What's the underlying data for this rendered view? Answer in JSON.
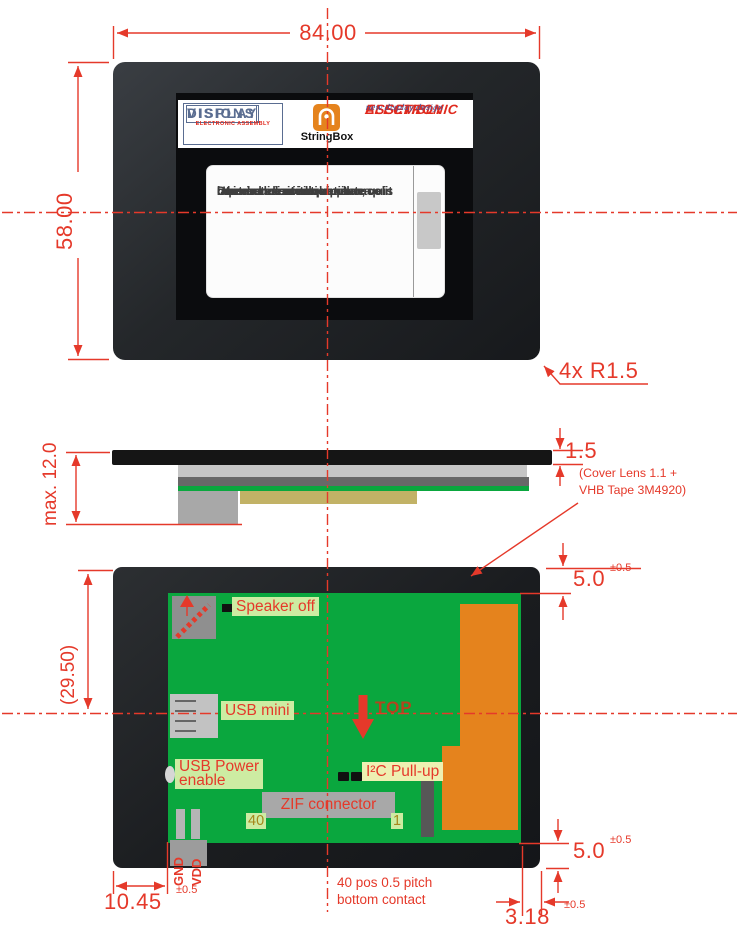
{
  "colors": {
    "dimension_red": "#e5392a",
    "pcb_green": "#0aa73e",
    "component_orange": "#e5831d",
    "label_green_bg": "#cdeca2",
    "label_yellow_bg": "#eef0b2",
    "logo_blue": "#5a6d91",
    "logo_red": "#e02a1e",
    "top_marker_red": "#b5441e",
    "pin_olive": "#a5871c"
  },
  "front_view": {
    "dim_width": "84.00",
    "dim_height": "58.00",
    "corner_note": "4x R1.5",
    "logo_display_visions": {
      "line1": "DISPLAY",
      "line2": "ELECTRONIC ASSEMBLY",
      "line3": "VISIONS"
    },
    "logo_stringbox": {
      "label": "StringBox"
    },
    "logo_electronic_assembly": {
      "line1": "ELECTRONIC",
      "line2": "ASSEMBLY",
      "tagline": "new display design"
    },
    "screen_lines": [
      "Ut enim ad minim veniam, quis",
      "nostrud exercitation ullamco",
      "laboris nisi ut aliquip ex ea",
      "commodo consequat.",
      "",
      "Duis aute irure dolor in",
      "reprehenderit in voluptate velit"
    ]
  },
  "side_view": {
    "dim_max_height": "max. 12.0",
    "dim_lens": "1.5",
    "lens_note_line1": "(Cover Lens 1.1 +",
    "lens_note_line2": "VHB Tape 3M4920)"
  },
  "back_view": {
    "dim_height": "(29.50)",
    "dim_pcb_top": "5.0",
    "dim_pcb_top_tol": "±0.5",
    "dim_pcb_bottom": "5.0",
    "dim_pcb_bottom_tol": "±0.5",
    "dim_usb_offset": "10.45",
    "dim_usb_offset_tol": "±0.5",
    "dim_contact_edge": "3.18",
    "dim_contact_edge_tol": "±0.5",
    "label_speaker": "Speaker off",
    "label_usb_mini": "USB mini",
    "label_usb_power_line1": "USB Power",
    "label_usb_power_line2": "enable",
    "label_i2c": "I²C Pull-up",
    "label_zif": "ZIF connector",
    "zif_pin_40": "40",
    "zif_pin_1": "1",
    "label_gnd": "GND",
    "label_vdd": "VDD",
    "label_top": "TOP",
    "contact_note_line1": "40 pos 0.5 pitch",
    "contact_note_line2": "bottom contact"
  }
}
